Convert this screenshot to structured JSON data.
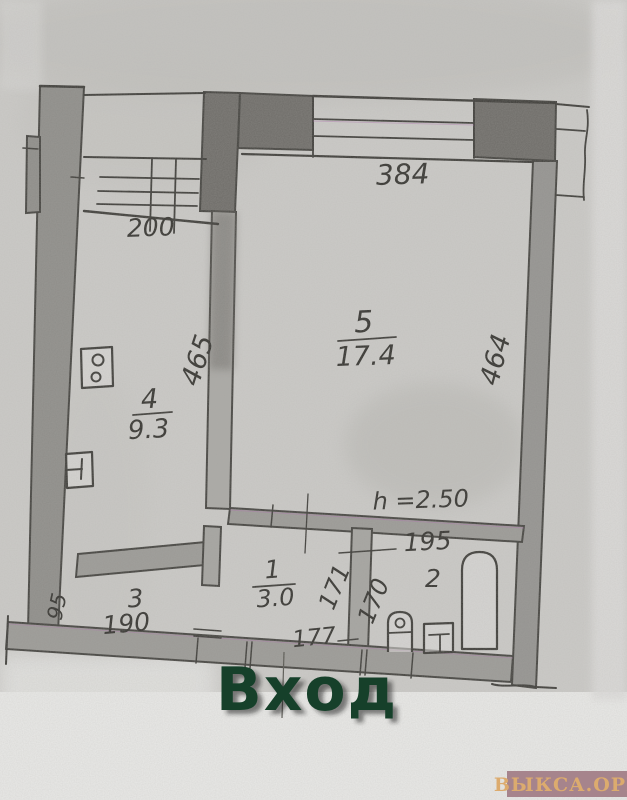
{
  "plan": {
    "entrance_label": "Вход",
    "rooms": [
      {
        "number": "5",
        "area": "17.4"
      },
      {
        "number": "4",
        "area": "9.3"
      },
      {
        "number": "1",
        "area": "3.0"
      },
      {
        "number": "3"
      },
      {
        "number": "2"
      }
    ],
    "dimensions": {
      "top_width": "384",
      "staircase_width": "200",
      "kitchen_depth": "465",
      "living_depth": "464",
      "ceiling_height": "h =2.50",
      "bathroom_width": "195",
      "hall_dim_a": "171",
      "hall_dim_b": "170",
      "hall_width": "177",
      "room3_width": "190",
      "room3_depth": "95"
    },
    "fixtures": [
      "staircase-icon",
      "stove-icon",
      "sink-icon",
      "bathtub-icon",
      "toilet-icon",
      "washbasin-icon"
    ],
    "colors": {
      "paper": "#cbcac7",
      "ink": "#3e3d39",
      "wall_fill": "#9b9a96",
      "wall_dark": "#6e6c68",
      "entrance_text": "#17402a"
    }
  },
  "watermark": {
    "label": "ВЫКСА.ОРГ",
    "bg_color": "#a6848c",
    "text_color": "#dcab6e"
  }
}
